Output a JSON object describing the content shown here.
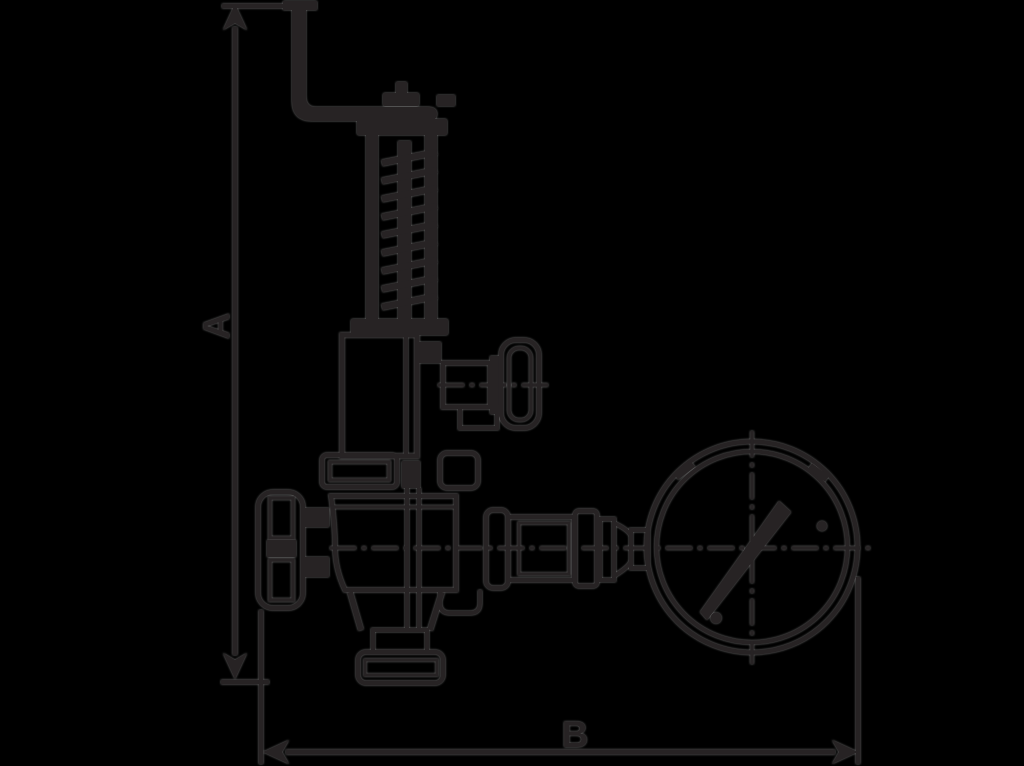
{
  "drawing": {
    "labels": {
      "height_dimension": "A",
      "width_dimension": "B"
    },
    "colors": {
      "background": "#000000",
      "ink": "#272324",
      "halo": "#7b7b7b"
    }
  }
}
